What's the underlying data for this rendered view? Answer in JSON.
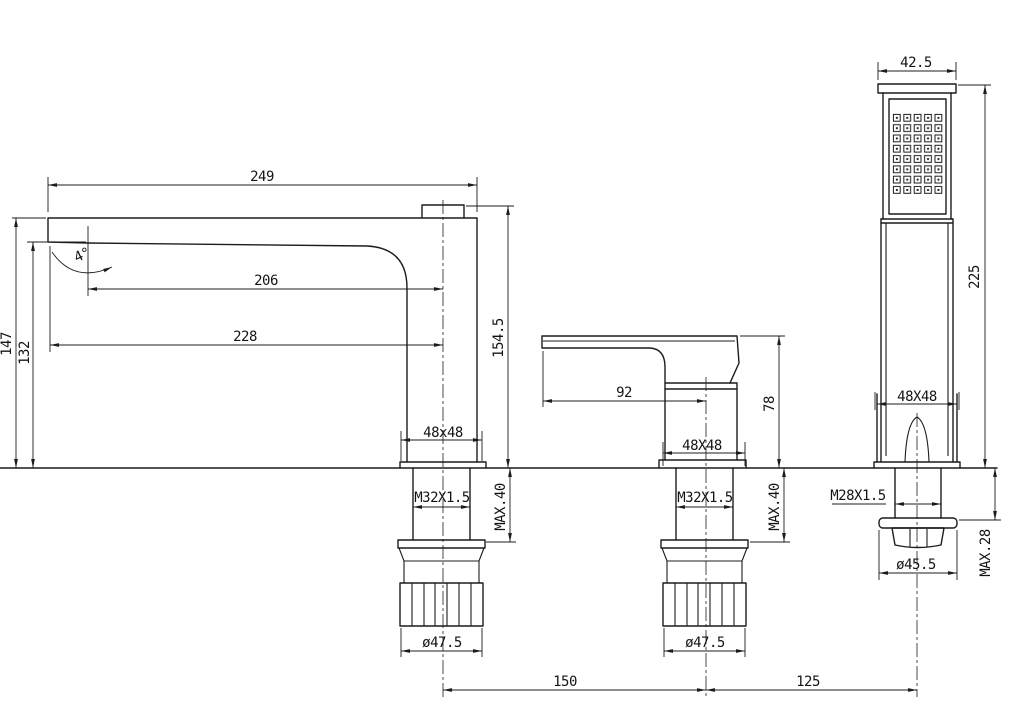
{
  "colors": {
    "background": "#ffffff",
    "line": "#1c1c1c"
  },
  "spout": {
    "reach": "249",
    "reach_to_bend": "206",
    "reach_overall": "228",
    "height_left": "147",
    "clearance_under": "132",
    "height_right": "154.5",
    "angle": "4°",
    "base": "48x48",
    "thread": "M32X1.5",
    "max_deck": "MAX.40",
    "nut_diameter": "ø47.5"
  },
  "valve": {
    "handle_reach": "92",
    "height": "78",
    "base": "48X48",
    "thread": "M32X1.5",
    "max_deck": "MAX.40",
    "nut_diameter": "ø47.5"
  },
  "shower": {
    "head_width": "42.5",
    "height": "225",
    "base": "48X48",
    "thread": "M28X1.5",
    "max_deck": "MAX.28",
    "nut_diameter": "ø45.5"
  },
  "spacing": {
    "spout_to_valve": "150",
    "valve_to_shower": "125"
  }
}
